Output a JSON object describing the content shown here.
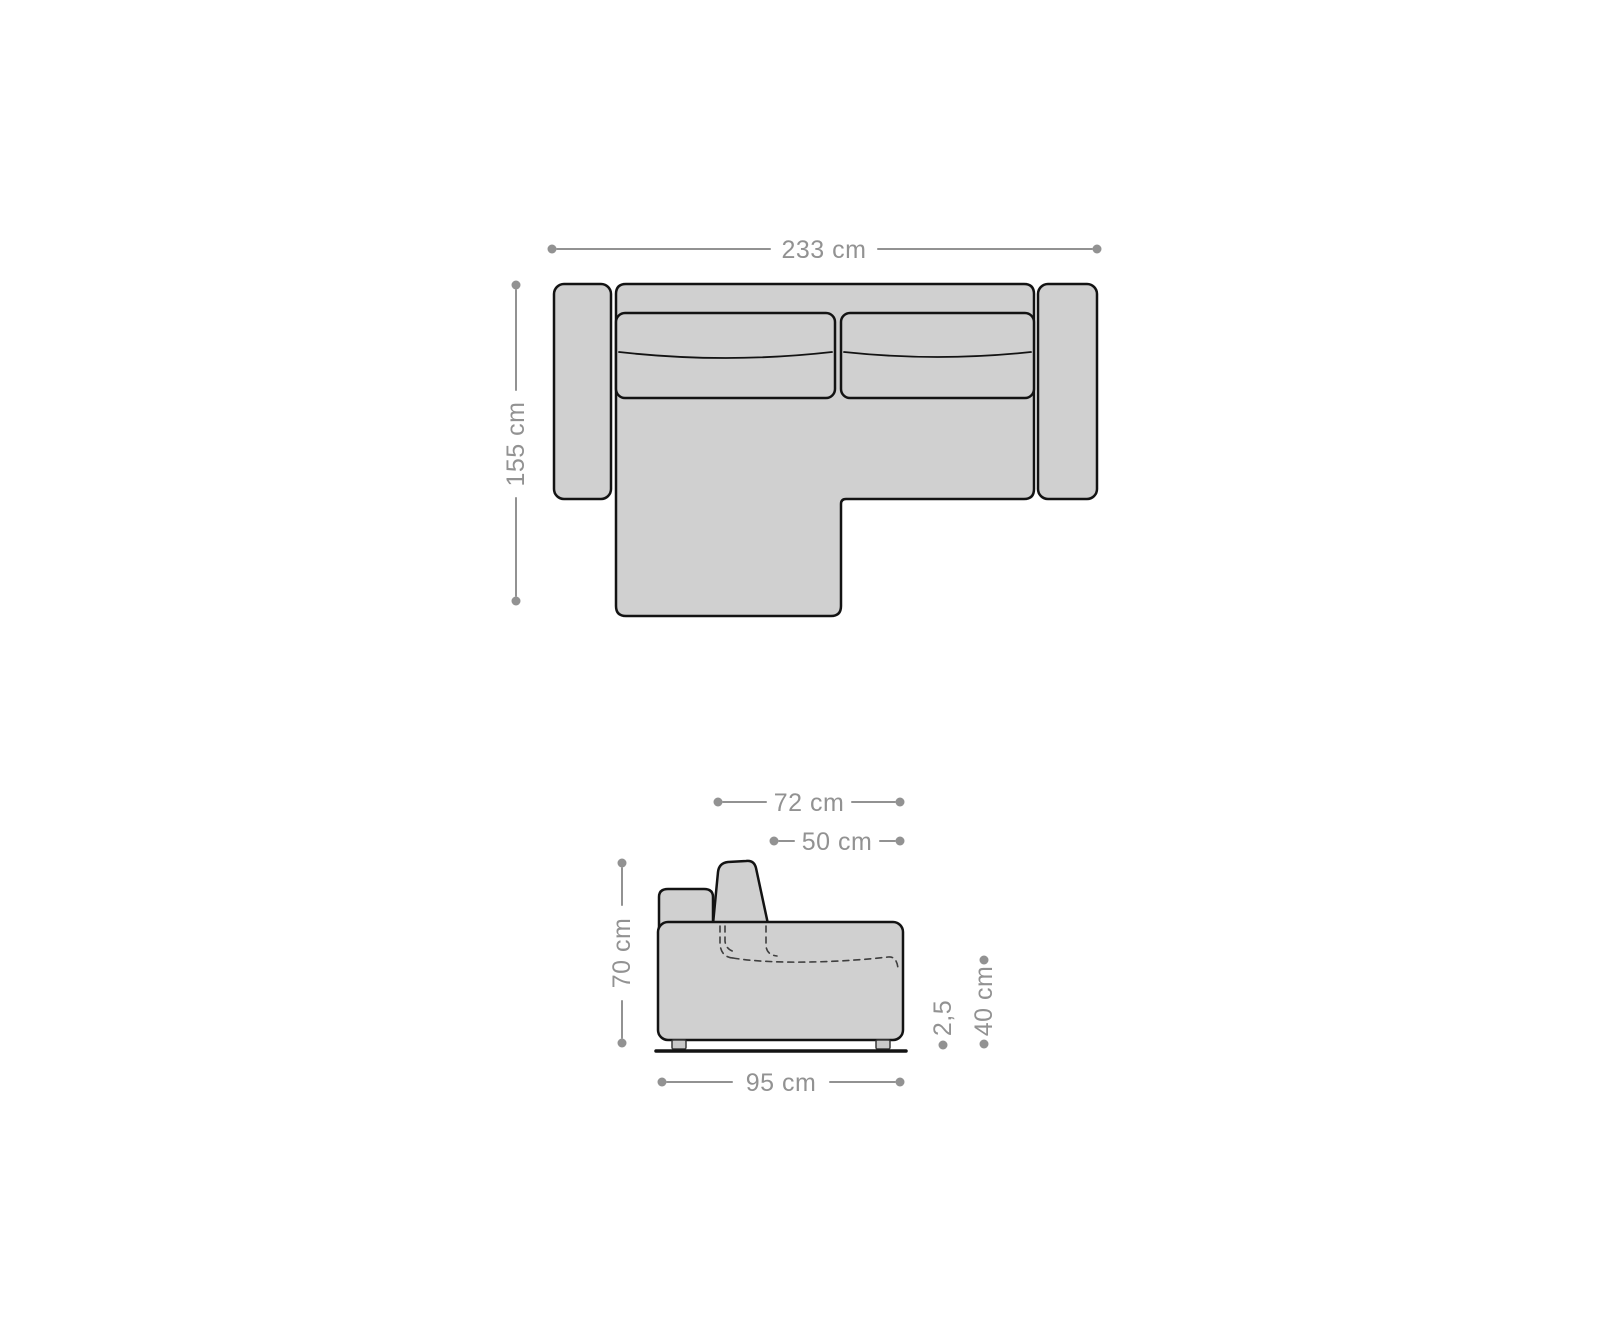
{
  "colors": {
    "background": "#ffffff",
    "sofa_fill": "#d0d0d0",
    "sofa_outline": "#131313",
    "foot_fill": "#c9c9c9",
    "dimension_color": "#929292"
  },
  "top_view": {
    "overall_width": "233 cm",
    "overall_depth": "155 cm"
  },
  "side_view": {
    "cushion_depth": "72 cm",
    "seat_depth": "50 cm",
    "back_height": "70 cm",
    "foot_height": "2,5",
    "seat_height": "40 cm",
    "total_depth": "95 cm"
  }
}
